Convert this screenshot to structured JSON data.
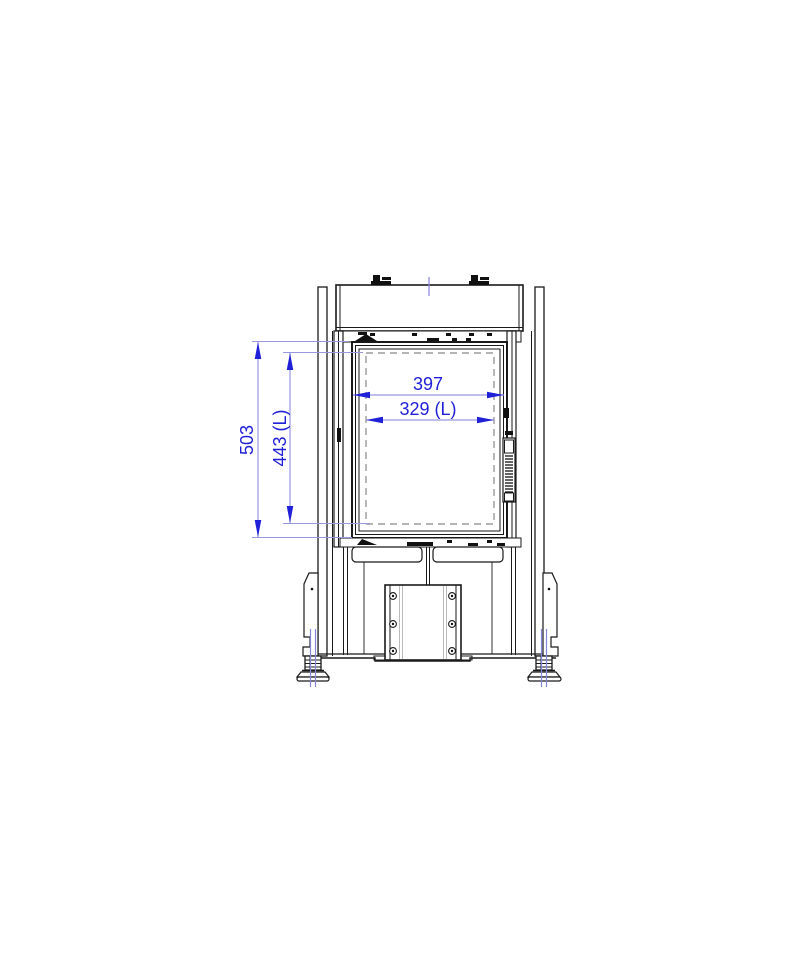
{
  "page": {
    "background": "#ffffff",
    "description": "CAD front-elevation technical drawing of a fireplace stove insert with blue dimension annotations"
  },
  "drawing": {
    "dimensions": {
      "width_outer": "397",
      "width_inner": "329 (L)",
      "height_outer": "503",
      "height_inner": "443 (L)"
    },
    "colors": {
      "line": "#1a1a1a",
      "hidden_dashed": "#9b9b9b",
      "dimension_text": "#2020d8",
      "dimension_line": "#9898e2",
      "centerline": "#8585de"
    }
  }
}
